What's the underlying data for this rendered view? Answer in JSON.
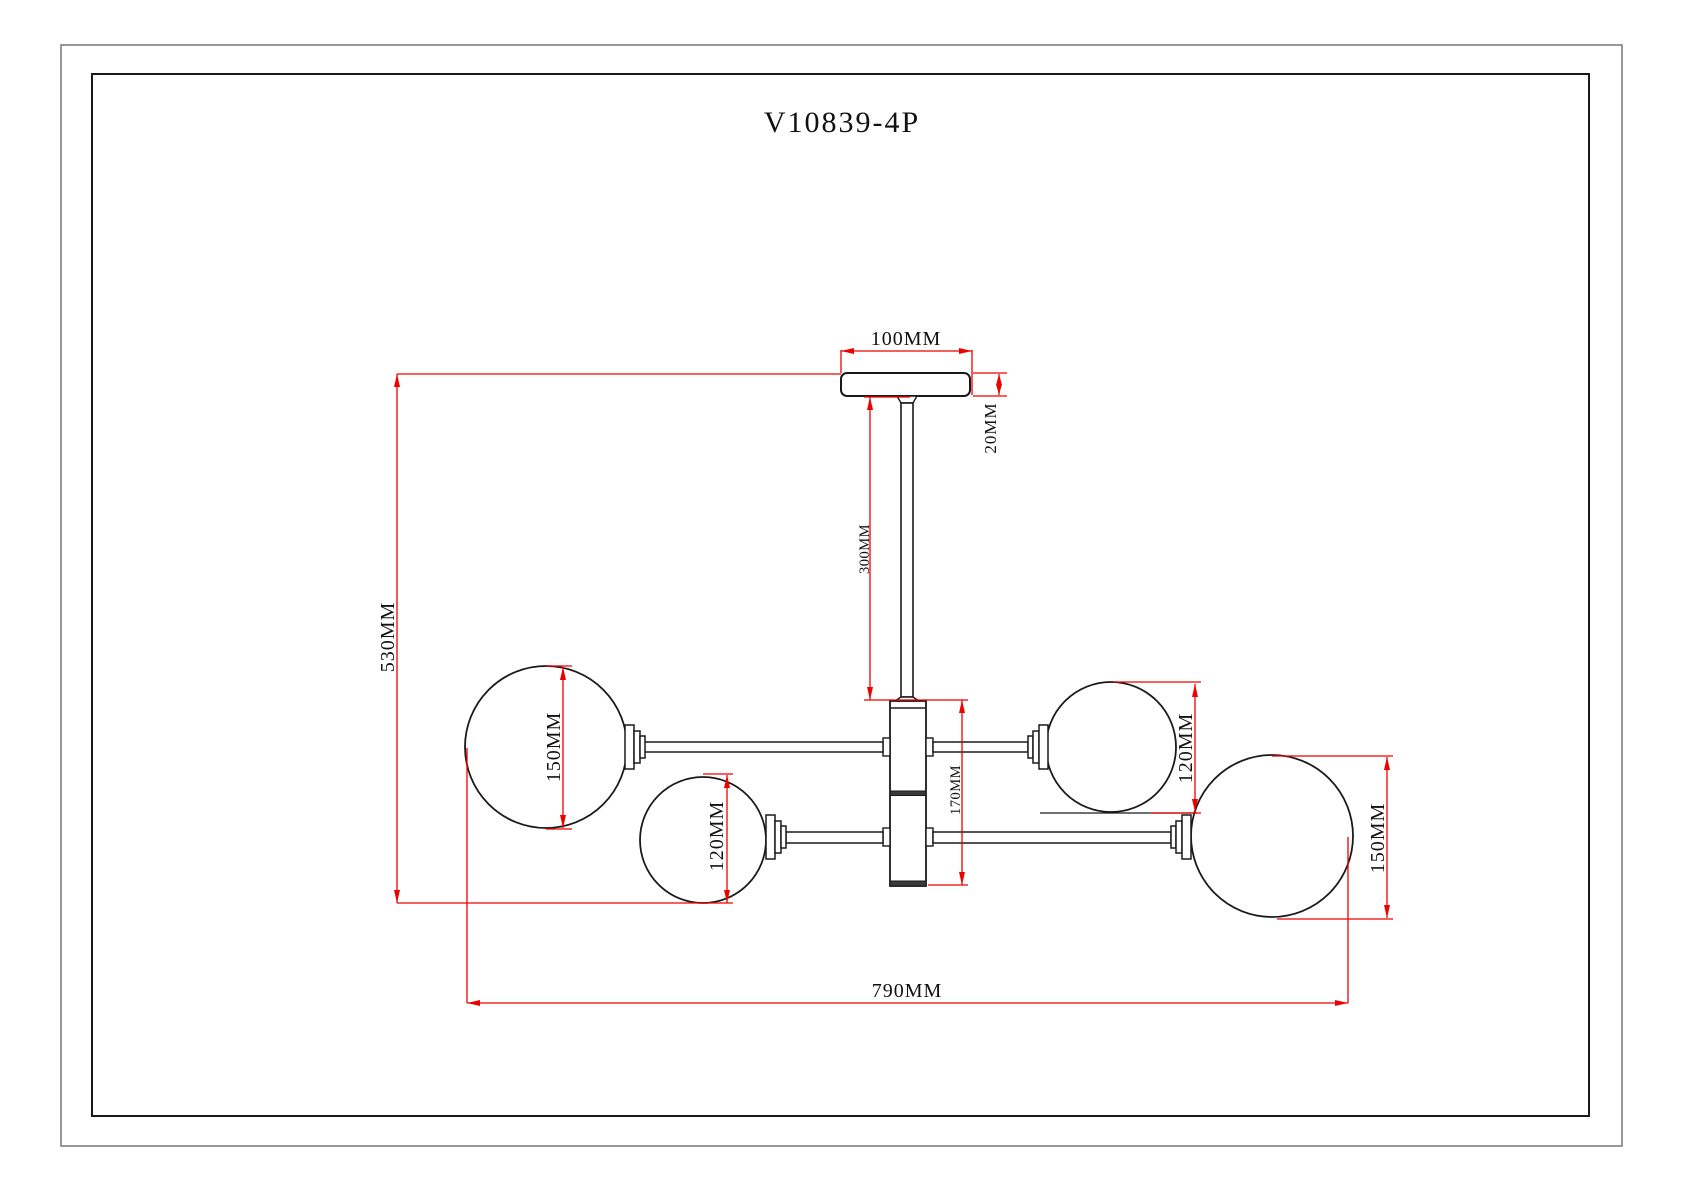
{
  "title": "V10839-4P",
  "product_type": "4-light semi-flush ceiling fixture technical drawing",
  "dimension_labels": {
    "canopy_width": "100MM",
    "canopy_thickness": "20MM",
    "stem_length": "300MM",
    "overall_height": "530MM",
    "left_large_globe": "150MM",
    "left_small_globe": "120MM",
    "center_body_height": "170MM",
    "right_small_globe": "120MM",
    "right_large_globe": "150MM",
    "overall_width": "790MM"
  },
  "colors": {
    "dimension_red": "#ee0000",
    "outline_black": "#1a1a1a",
    "paper_white": "#ffffff"
  }
}
